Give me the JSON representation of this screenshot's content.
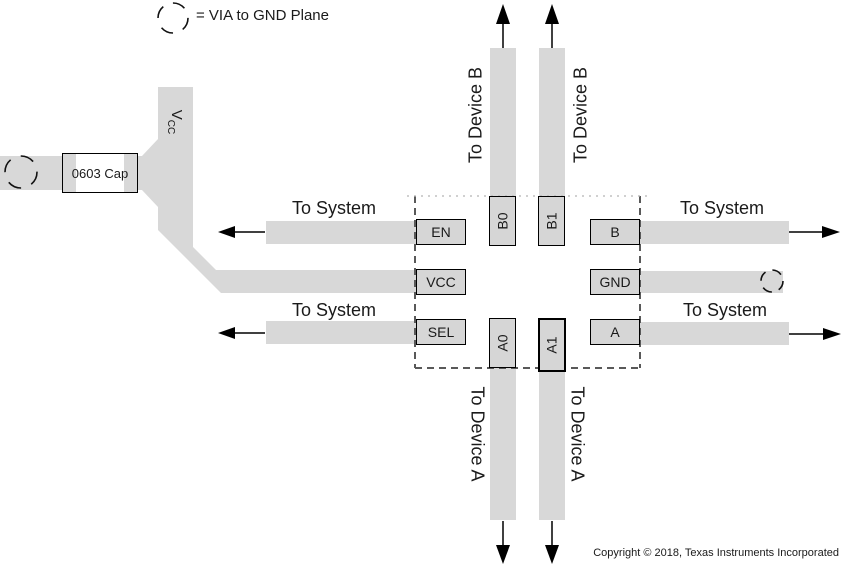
{
  "legend": {
    "label": "= VIA to GND Plane",
    "icon": "dashed-circle-via"
  },
  "left_circuit": {
    "cap_label": "0603 Cap",
    "vcc_main": "V",
    "vcc_sub": "CC"
  },
  "ic_pins": {
    "en": "EN",
    "vcc": "VCC",
    "sel": "SEL",
    "b0": "B0",
    "b1": "B1",
    "b": "B",
    "gnd": "GND",
    "a": "A",
    "a0": "A0",
    "a1": "A1"
  },
  "flow_labels": {
    "to_system": "To System",
    "to_device_b": "To Device B",
    "to_device_a": "To Device A"
  },
  "footer": {
    "copyright": "Copyright © 2018, Texas Instruments Incorporated"
  },
  "colors": {
    "trace": "#d8d8d8",
    "pin_fill": "#d6d6d6",
    "outline": "#000000",
    "ic_dash": "#595959"
  }
}
